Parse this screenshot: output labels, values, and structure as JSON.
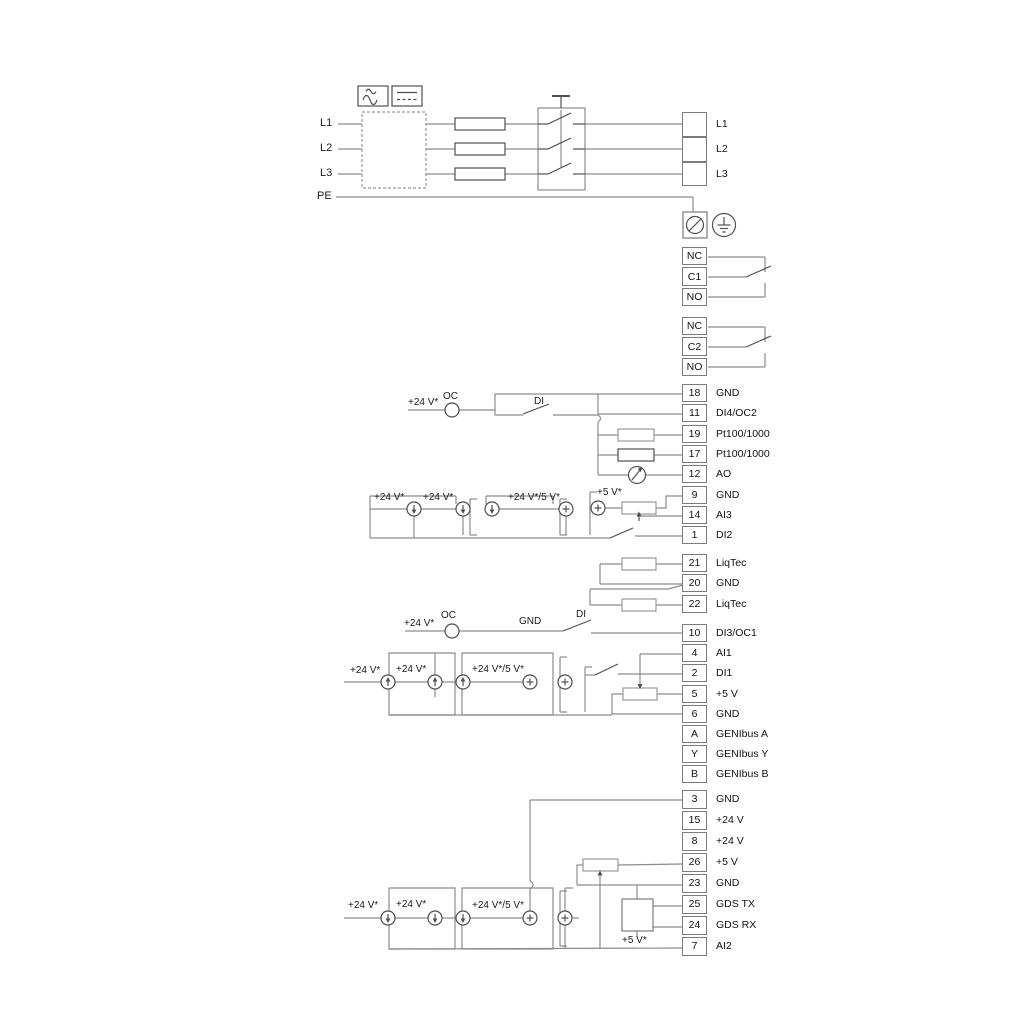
{
  "power": {
    "inputs": [
      "L1",
      "L2",
      "L3",
      "PE"
    ],
    "icons": [
      "ac-wave-icon",
      "dc-lines-icon"
    ]
  },
  "terminal_groups": {
    "power_out": [
      {
        "num": "",
        "label": "L1"
      },
      {
        "num": "",
        "label": "L2"
      },
      {
        "num": "",
        "label": "L3"
      }
    ],
    "relay1": [
      {
        "num": "NC",
        "label": ""
      },
      {
        "num": "C1",
        "label": ""
      },
      {
        "num": "NO",
        "label": ""
      }
    ],
    "relay2": [
      {
        "num": "NC",
        "label": ""
      },
      {
        "num": "C2",
        "label": ""
      },
      {
        "num": "NO",
        "label": ""
      }
    ],
    "io_top": [
      {
        "num": "18",
        "label": "GND"
      },
      {
        "num": "11",
        "label": "DI4/OC2"
      },
      {
        "num": "19",
        "label": "Pt100/1000"
      },
      {
        "num": "17",
        "label": "Pt100/1000"
      },
      {
        "num": "12",
        "label": "AO"
      },
      {
        "num": "9",
        "label": "GND"
      },
      {
        "num": "14",
        "label": "AI3"
      },
      {
        "num": "1",
        "label": "DI2"
      }
    ],
    "liqtec": [
      {
        "num": "21",
        "label": "LiqTec"
      },
      {
        "num": "20",
        "label": "GND"
      },
      {
        "num": "22",
        "label": "LiqTec"
      }
    ],
    "io_mid": [
      {
        "num": "10",
        "label": "DI3/OC1"
      },
      {
        "num": "4",
        "label": "AI1"
      },
      {
        "num": "2",
        "label": "DI1"
      },
      {
        "num": "5",
        "label": "+5 V"
      },
      {
        "num": "6",
        "label": "GND"
      },
      {
        "num": "A",
        "label": "GENIbus A"
      },
      {
        "num": "Y",
        "label": "GENIbus Y"
      },
      {
        "num": "B",
        "label": "GENIbus B"
      }
    ],
    "io_bottom": [
      {
        "num": "3",
        "label": "GND"
      },
      {
        "num": "15",
        "label": "+24 V"
      },
      {
        "num": "8",
        "label": "+24 V"
      },
      {
        "num": "26",
        "label": "+5 V"
      },
      {
        "num": "23",
        "label": "GND"
      },
      {
        "num": "25",
        "label": "GDS TX"
      },
      {
        "num": "24",
        "label": "GDS RX"
      },
      {
        "num": "7",
        "label": "AI2"
      }
    ]
  },
  "annotations": {
    "di4": {
      "v24": "+24 V*",
      "oc": "OC",
      "di": "DI"
    },
    "ai3": {
      "v24_a": "+24 V*",
      "v24_b": "+24 V*",
      "v24_5": "+24 V*/5 V*",
      "v5": "+5 V*"
    },
    "di3": {
      "v24": "+24 V*",
      "oc": "OC",
      "gnd": "GND",
      "di": "DI"
    },
    "ai1": {
      "v24_a": "+24 V*",
      "v24_b": "+24 V*",
      "v24_5": "+24 V*/5 V*"
    },
    "ai2": {
      "v24_a": "+24 V*",
      "v24_b": "+24 V*",
      "v24_5": "+24 V*/5 V*",
      "v5": "+5 V*"
    }
  },
  "colors": {
    "wire": "#8c8c8c",
    "dark": "#4f4f4f",
    "text": "#1a1a1a"
  }
}
